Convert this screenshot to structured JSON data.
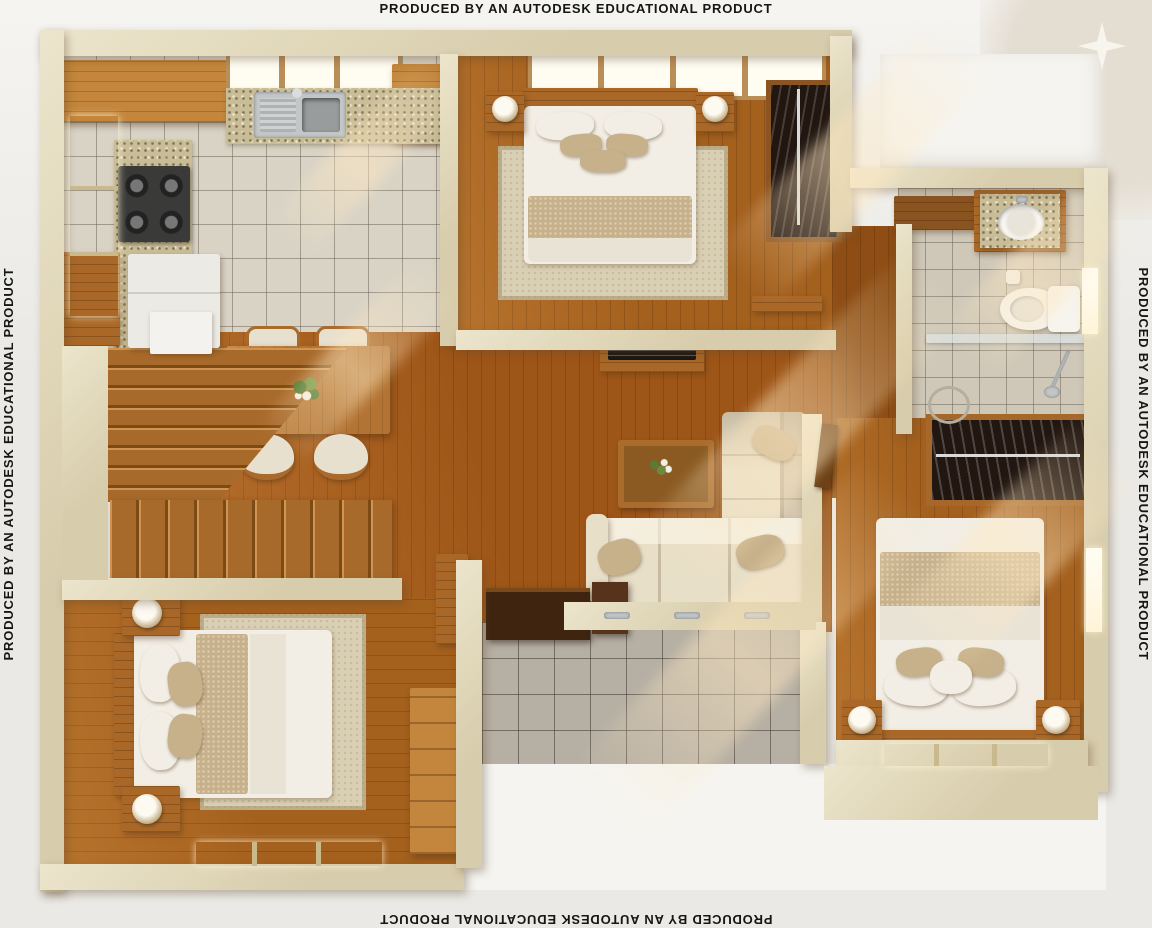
{
  "watermarks": {
    "top": "PRODUCED BY AN AUTODESK EDUCATIONAL PRODUCT",
    "bottom": "PRODUCED BY AN AUTODESK EDUCATIONAL PRODUCT",
    "left": "PRODUCED BY AN AUTODESK EDUCATIONAL PRODUCT",
    "right": "PRODUCED BY AN AUTODESK EDUCATIONAL PRODUCT"
  },
  "icons": {
    "sparkle": "four-pointed-star"
  },
  "scene": {
    "type": "3d-floor-plan-render",
    "rooms": [
      "kitchen",
      "master-bedroom",
      "bathroom",
      "hallway",
      "living-room",
      "dining-area",
      "staircase",
      "bedroom-2",
      "bedroom-3",
      "patio"
    ]
  },
  "palette": {
    "bg": "#eae9e5",
    "bg_top": "#f5f4f1",
    "corner_beige": "#e4ddd2",
    "sparkle": "#f8f5ef",
    "ink": "#161616",
    "wall": "#d7ccab",
    "wall_hi": "#ece5cc",
    "wood": "#a4601d",
    "cabinet": "#a96827",
    "cabinet_light": "#c3863c",
    "tile_kitchen": "#d9d3c6",
    "tile_bath": "#cfc8b9",
    "tile_patio": "#b6afa3",
    "mosaic": "#c9bd97",
    "dark_wardrobe": "#221610",
    "bed_white": "#f2eee5",
    "bed_tan": "#c7b18b",
    "rug": "#d9cfb4",
    "sofa": "#e8dfc8",
    "sofa_shadow": "#cdc0a2",
    "glass": "#dfe7ea",
    "steel": "#c2c6c7",
    "white_ext": "#f5f4f0",
    "win": "#fff4d8",
    "sun": "#ffe9c2",
    "appliance": "#eceae5"
  }
}
